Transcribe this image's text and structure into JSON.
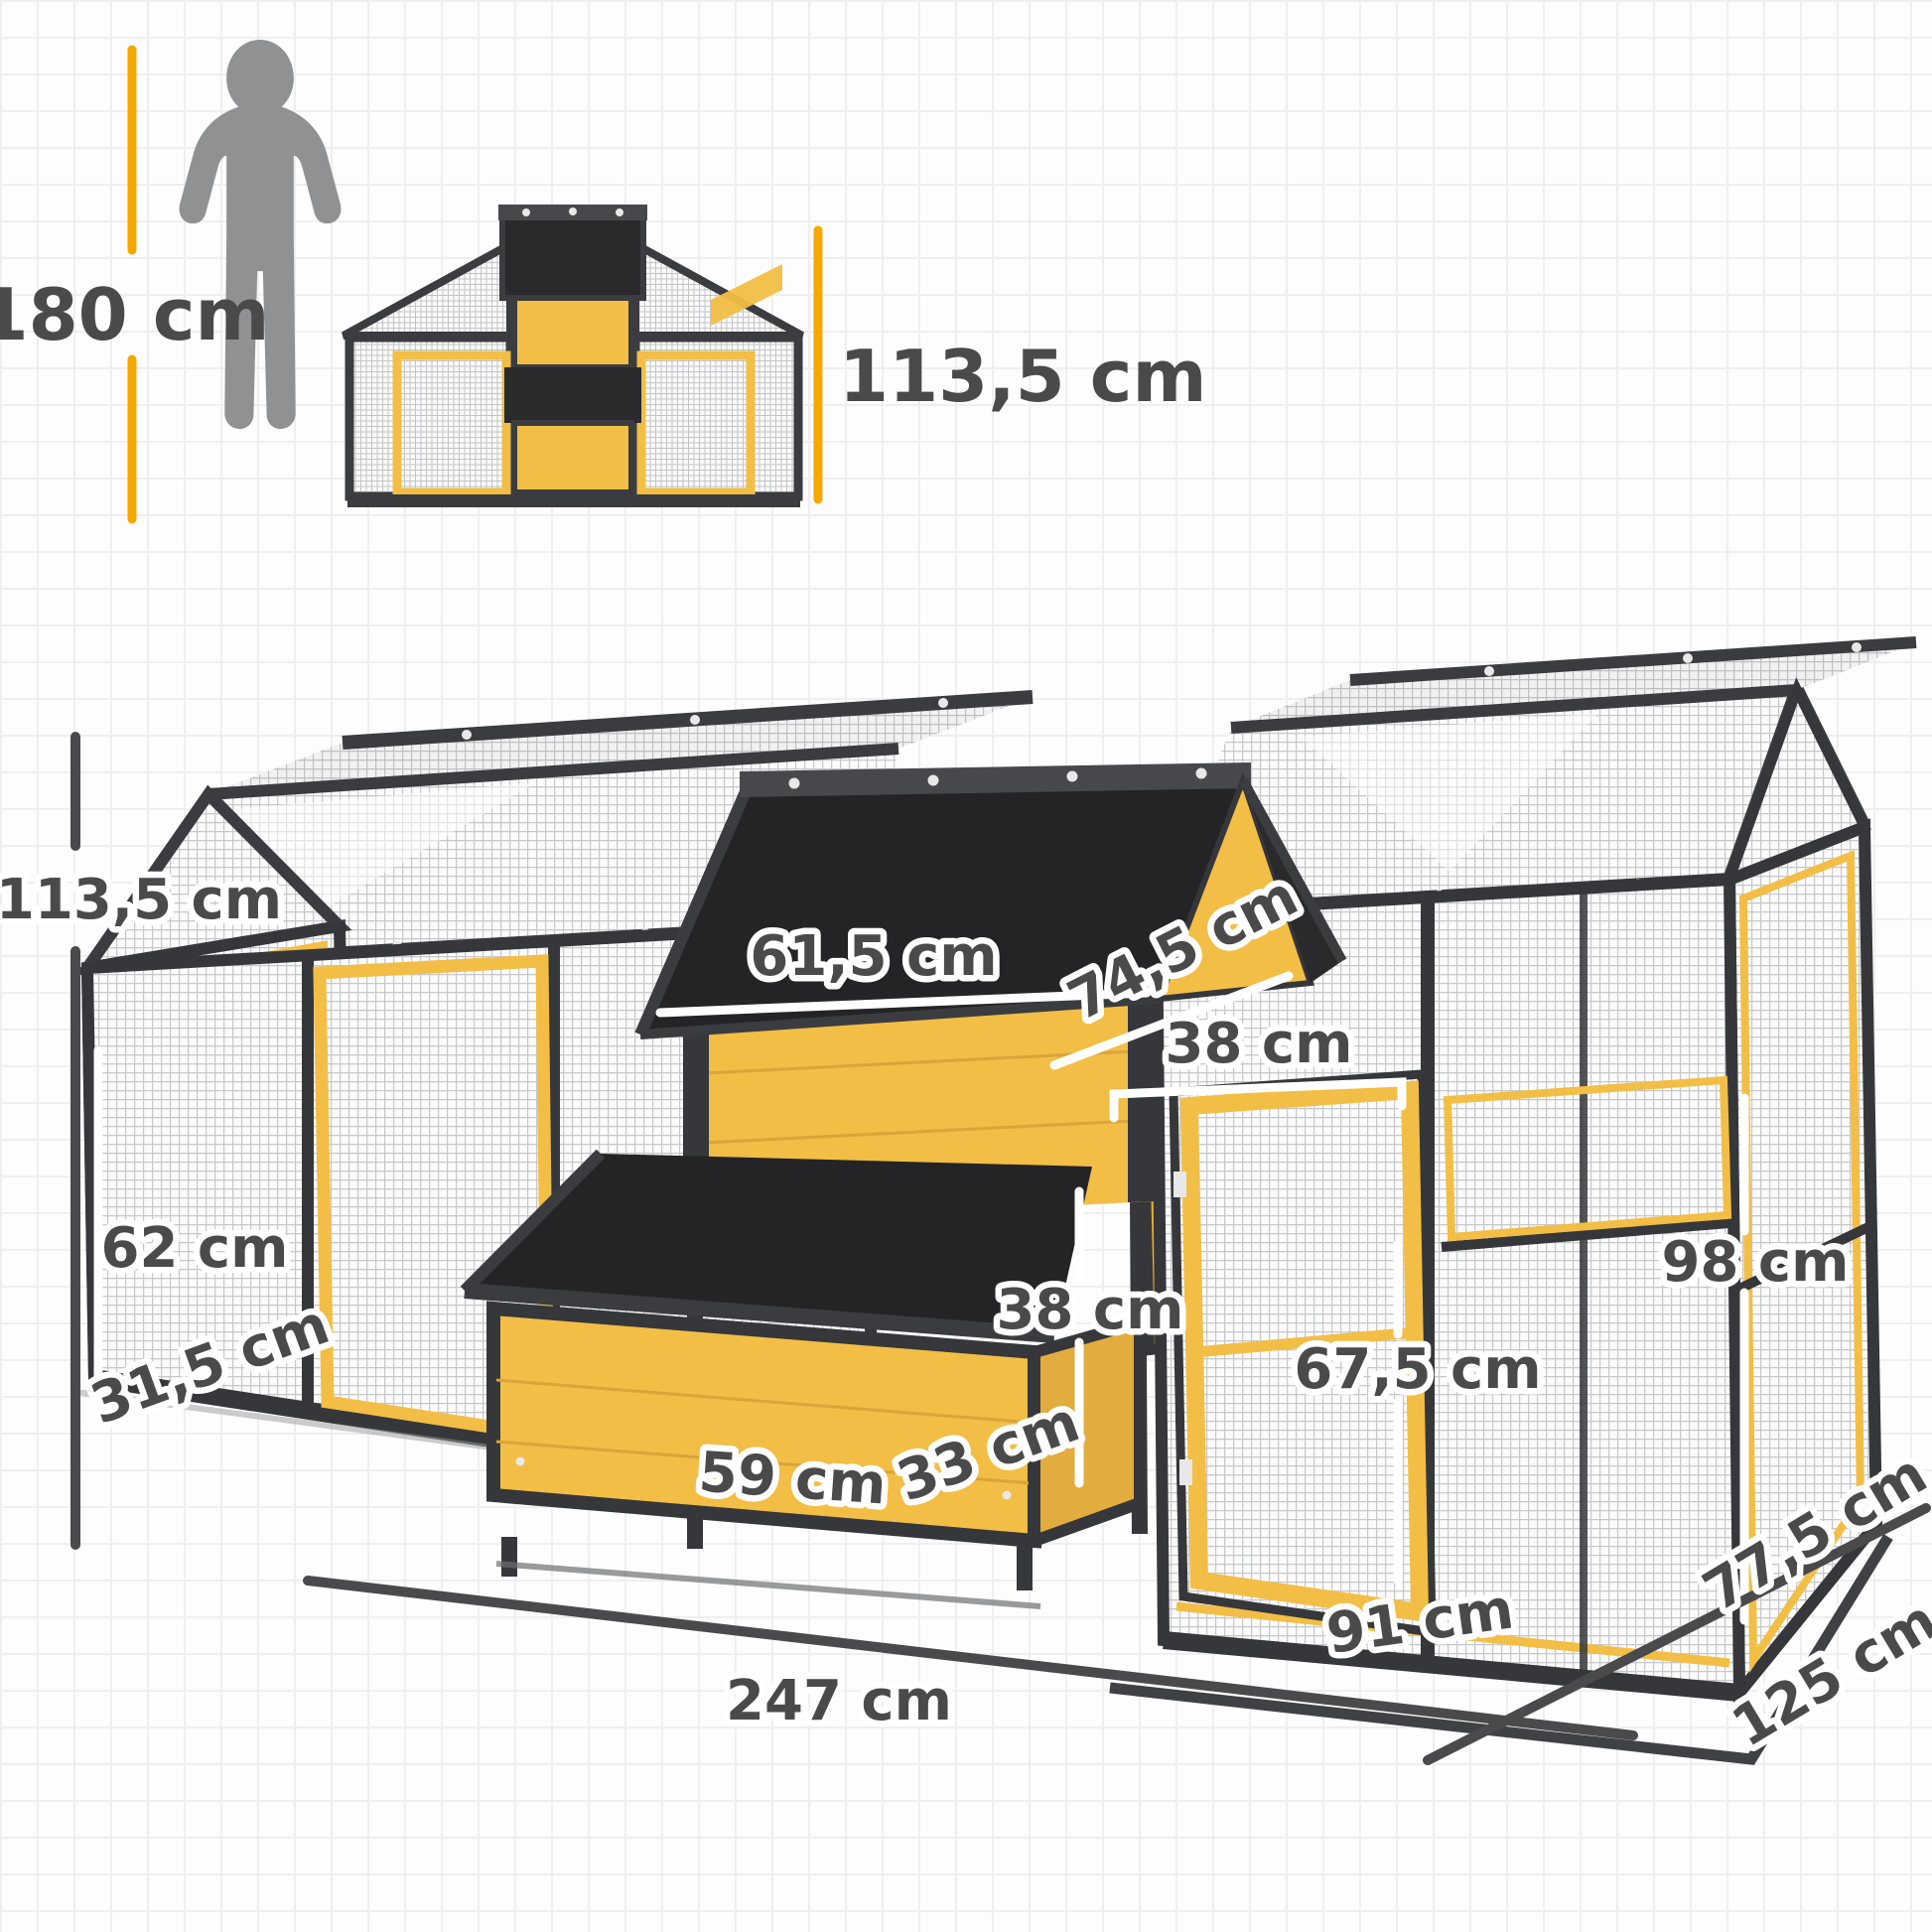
{
  "image_type": "chicken coop product dimension diagram",
  "colors": {
    "yellow_wood": "#F2BE45",
    "yellow_wood_shade": "#E2AC3F",
    "roof_black": "#242426",
    "frame_dark": "#35373A",
    "ridge_cap": "#46484C",
    "label_text": "#4A4A4A",
    "dimension_accent_yellow": "#F5A800",
    "mesh_line": "#C6C8CA",
    "silhouette_gray": "#8F9193"
  },
  "scale_figure": {
    "human_height_label": "180 cm",
    "product_height_label": "113,5 cm"
  },
  "labels": {
    "total_height": "113,5 cm",
    "front_panel_height": "62 cm",
    "left_depth": "31,5 cm",
    "house_width": "61,5 cm",
    "roof_slope_depth": "74,5 cm",
    "house_door_width": "38 cm",
    "nest_box_height": "38 cm",
    "run_wall_height": "98 cm",
    "run_door_height": "67,5 cm",
    "nest_box_width": "59 cm",
    "nest_box_depth": "33 cm",
    "run_door_width": "91 cm",
    "total_width": "247 cm",
    "base_depth": "77,5 cm",
    "total_depth": "125 cm"
  }
}
